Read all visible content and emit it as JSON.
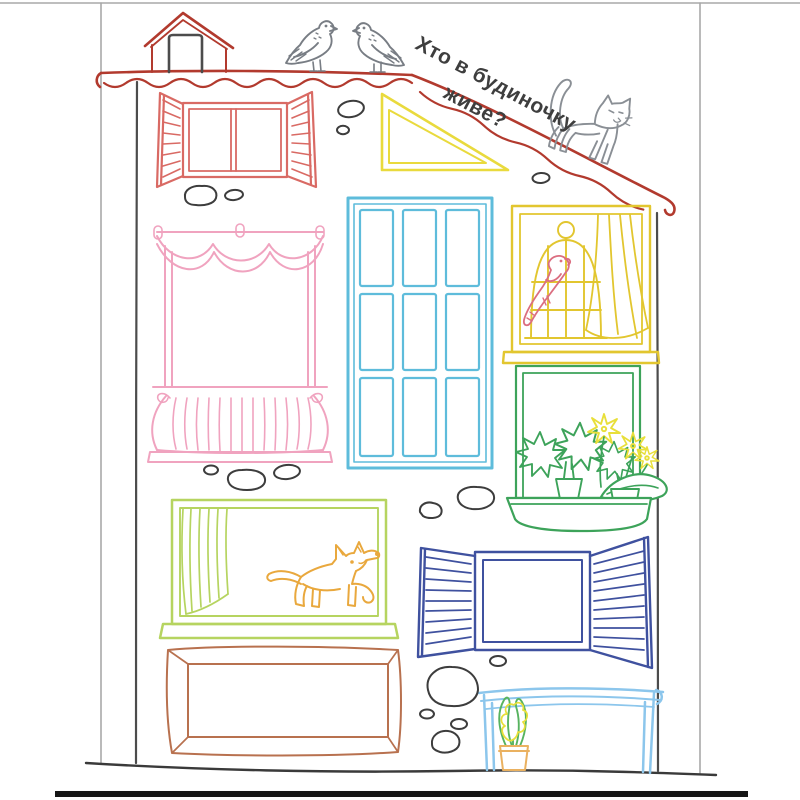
{
  "question": {
    "line1": "Хто в будиночку",
    "line2": "живе?"
  },
  "colors": {
    "page_border": "#a8a8a8",
    "bottom_bar": "#161616",
    "ground": "#3a3a3a",
    "wall": "#4c4c4c",
    "roof_red": "#b23a2e",
    "red_window": "#d96a64",
    "triangle_yellow": "#e9da3d",
    "pink_window": "#f0a3bf",
    "blue_window": "#5ebcdb",
    "cage_yellow": "#e2c62f",
    "parrot_pink": "#db6e80",
    "green_window": "#3da35a",
    "flower_yellow": "#e8df3a",
    "lime_window": "#b6d460",
    "dog_orange": "#e9a83d",
    "navy_window": "#3f519f",
    "brown_frame": "#b8714f",
    "skyblue_window": "#8cc6ec",
    "pot_orange": "#eab160",
    "plant_green": "#57b35f",
    "bird_gray": "#787d84",
    "cat_gray": "#8a8f95",
    "stone_gray": "#3d3d3d",
    "text": "#3e3e3e"
  },
  "objects": {
    "dormer": "little hut on the roof",
    "pigeons": "two pigeons standing on the roof",
    "cat": "cat walking on the sloped roof",
    "parrot": "parrot in a dome cage",
    "dog": "puppy in the window",
    "window_flowers": "window box with leafy plants and yellow flowers",
    "hyacinth": "potted hyacinth in basement window",
    "stones": "pebbles on the wall"
  }
}
